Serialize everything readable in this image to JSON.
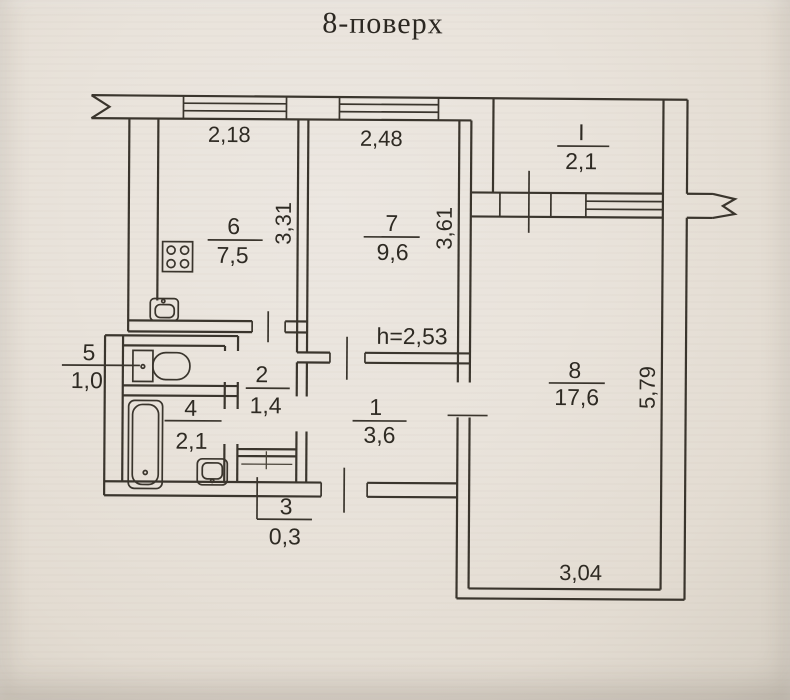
{
  "title": "8-поверх",
  "colors": {
    "paper": "#e8e2d9",
    "ink": "#3a352d"
  },
  "rooms": {
    "r1": {
      "number": "1",
      "area": "3,6"
    },
    "r2": {
      "number": "2",
      "area": "1,4"
    },
    "r3": {
      "number": "3",
      "area": "0,3"
    },
    "r4": {
      "number": "4",
      "area": "2,1"
    },
    "r5": {
      "number": "5",
      "area": "1,0"
    },
    "r6": {
      "number": "6",
      "area": "7,5"
    },
    "r7": {
      "number": "7",
      "area": "9,6"
    },
    "r8": {
      "number": "8",
      "area": "17,6"
    },
    "loggia": {
      "number": "I",
      "area": "2,1"
    }
  },
  "dimensions": {
    "kitchen_width": "2,18",
    "room7_width": "2,48",
    "kitchen_depth": "3,31",
    "room7_depth": "3,61",
    "ceiling_height": "h=2,53",
    "room8_depth": "5,79",
    "room8_width": "3,04"
  },
  "icons": {
    "stove": "stove-icon",
    "kitchen_sink": "sink-icon",
    "toilet": "toilet-icon",
    "bathtub": "bathtub-icon",
    "bathroom_sink": "sink-icon",
    "window": "window-symbol",
    "door_mark": "door-opening-tick",
    "wall_break": "break-symbol"
  }
}
